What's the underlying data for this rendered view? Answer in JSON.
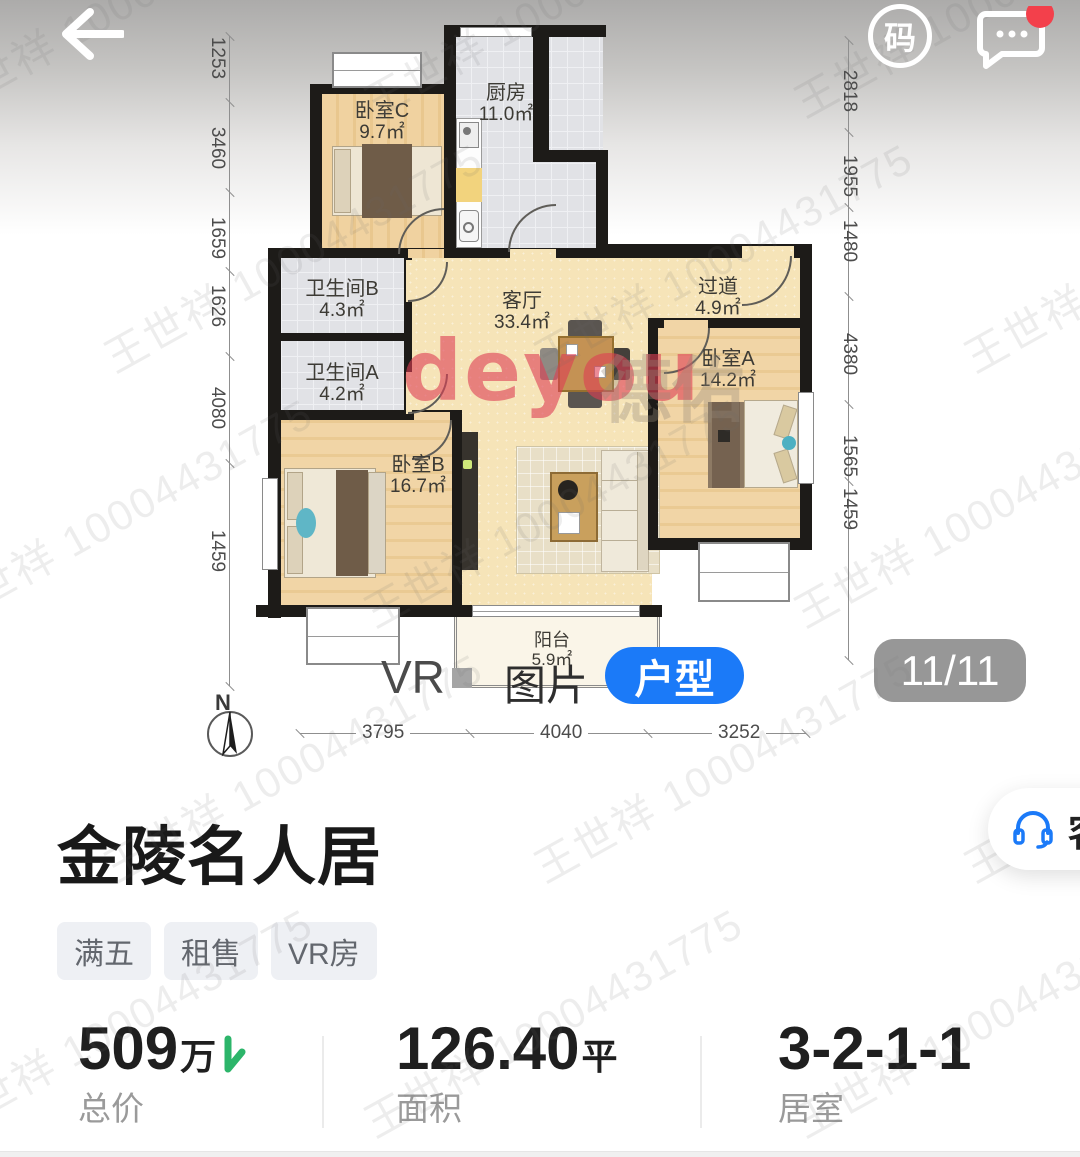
{
  "header": {
    "back_icon": "back-arrow",
    "qr_label": "码",
    "chat_icon": "chat-bubble"
  },
  "floorplan": {
    "rooms": [
      {
        "name": "卧室C",
        "area": "9.7㎡"
      },
      {
        "name": "厨房",
        "area": "11.0㎡"
      },
      {
        "name": "卫生间B",
        "area": "4.3㎡"
      },
      {
        "name": "卫生间A",
        "area": "4.2㎡"
      },
      {
        "name": "客厅",
        "area": "33.4㎡"
      },
      {
        "name": "过道",
        "area": "4.9㎡"
      },
      {
        "name": "卧室A",
        "area": "14.2㎡"
      },
      {
        "name": "卧室B",
        "area": "16.7㎡"
      },
      {
        "name": "阳台",
        "area": "5.9㎡"
      }
    ],
    "dims_left": [
      "1253",
      "3460",
      "1659",
      "1626",
      "4080",
      "1459"
    ],
    "dims_right": [
      "2818",
      "1955",
      "1480",
      "4380",
      "1565",
      "1459"
    ],
    "dims_bottom": [
      "3795",
      "4040",
      "3252"
    ],
    "north_label": "N",
    "brand_watermark": "deyou",
    "brand_watermark_cn": "德佑"
  },
  "viewer": {
    "tabs": [
      {
        "label": "VR",
        "active": false
      },
      {
        "label": "图片",
        "active": false
      },
      {
        "label": "户型",
        "active": true
      }
    ],
    "pager": "11/11"
  },
  "listing": {
    "title": "金陵名人居",
    "tags": [
      "满五",
      "租售",
      "VR房"
    ],
    "stats": [
      {
        "value": "509",
        "unit": "万",
        "label": "总价",
        "trend": "down"
      },
      {
        "value": "126.40",
        "unit": "平",
        "label": "面积"
      },
      {
        "value": "3-2-1-1",
        "unit": "",
        "label": "居室"
      }
    ]
  },
  "floating": {
    "service_label": "客"
  },
  "watermark": {
    "text": "王世祥 10004431775"
  },
  "colors": {
    "accent_blue": "#1b7af8",
    "price_green": "#2cb56a",
    "notify_red": "#f3404b",
    "brand_red": "#de3e54"
  }
}
